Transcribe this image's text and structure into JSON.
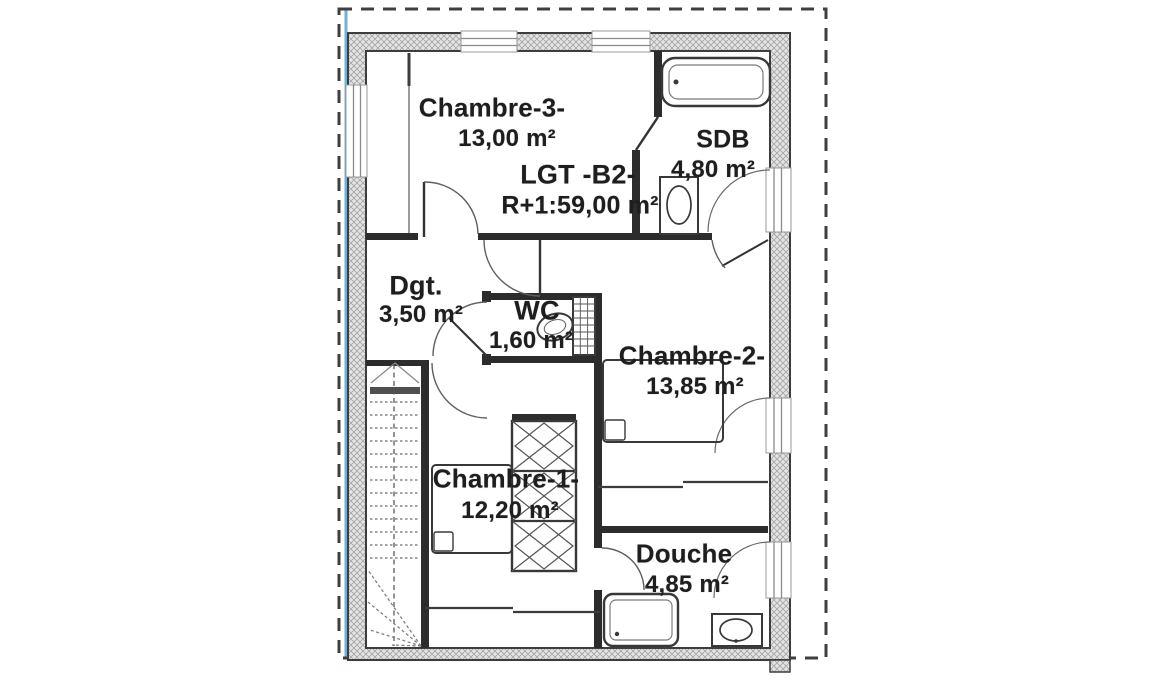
{
  "plan": {
    "rooms": [
      {
        "id": "chambre-3",
        "name": "Chambre-3-",
        "area": "13,00 m²"
      },
      {
        "id": "sdb",
        "name": "SDB",
        "area": "4,80 m²"
      },
      {
        "id": "lgt-b2",
        "name": "LGT -B2-",
        "area": "R+1:59,00 m²"
      },
      {
        "id": "dgt",
        "name": "Dgt.",
        "area": "3,50 m²"
      },
      {
        "id": "wc",
        "name": "WC",
        "area": "1,60 m²"
      },
      {
        "id": "chambre-2",
        "name": "Chambre-2-",
        "area": "13,85 m²"
      },
      {
        "id": "chambre-1",
        "name": "Chambre-1-",
        "area": "12,20 m²"
      },
      {
        "id": "douche",
        "name": "Douche",
        "area": "4,85 m²"
      }
    ],
    "fixtures": [
      "bathtub",
      "washbasin",
      "toilet",
      "shower-tray",
      "bed",
      "wardrobe",
      "staircase"
    ],
    "colors": {
      "scan_line_blue": "#63a9cf",
      "wall_hatch_fill": "#e4e4e4",
      "wall_hatch_stroke": "#a6a6a6",
      "ink": "#2c2c2c",
      "text": "#1e1e1e",
      "paper": "#ffffff"
    }
  }
}
